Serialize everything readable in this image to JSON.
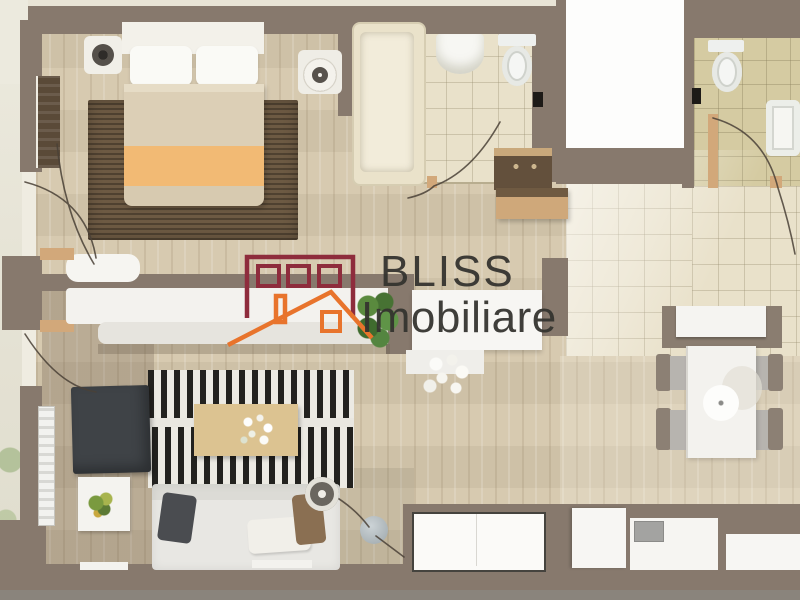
{
  "watermark": {
    "line1": "BLISS",
    "line2": "Imobiliare"
  },
  "logo": {
    "icon": "bliss-house-logo-icon",
    "building_outline_color": "#8E2C3C",
    "roof_color": "#E8742C",
    "text_color": "#34332F"
  },
  "palette": {
    "wall_taupe": "#87796D",
    "wood_floor": "#D5C7AC",
    "tile_cream": "#E9E1CA",
    "tile_olive": "#D5CBA2",
    "bedroom_rug_brown": "#6D5A43",
    "blanket_orange": "#F2BA74",
    "living_rug_stripe_dark": "#23221F",
    "armchair_charcoal": "#3F4347",
    "coffee_table_tan": "#DCC391",
    "plant_green": "#4C7A36"
  }
}
